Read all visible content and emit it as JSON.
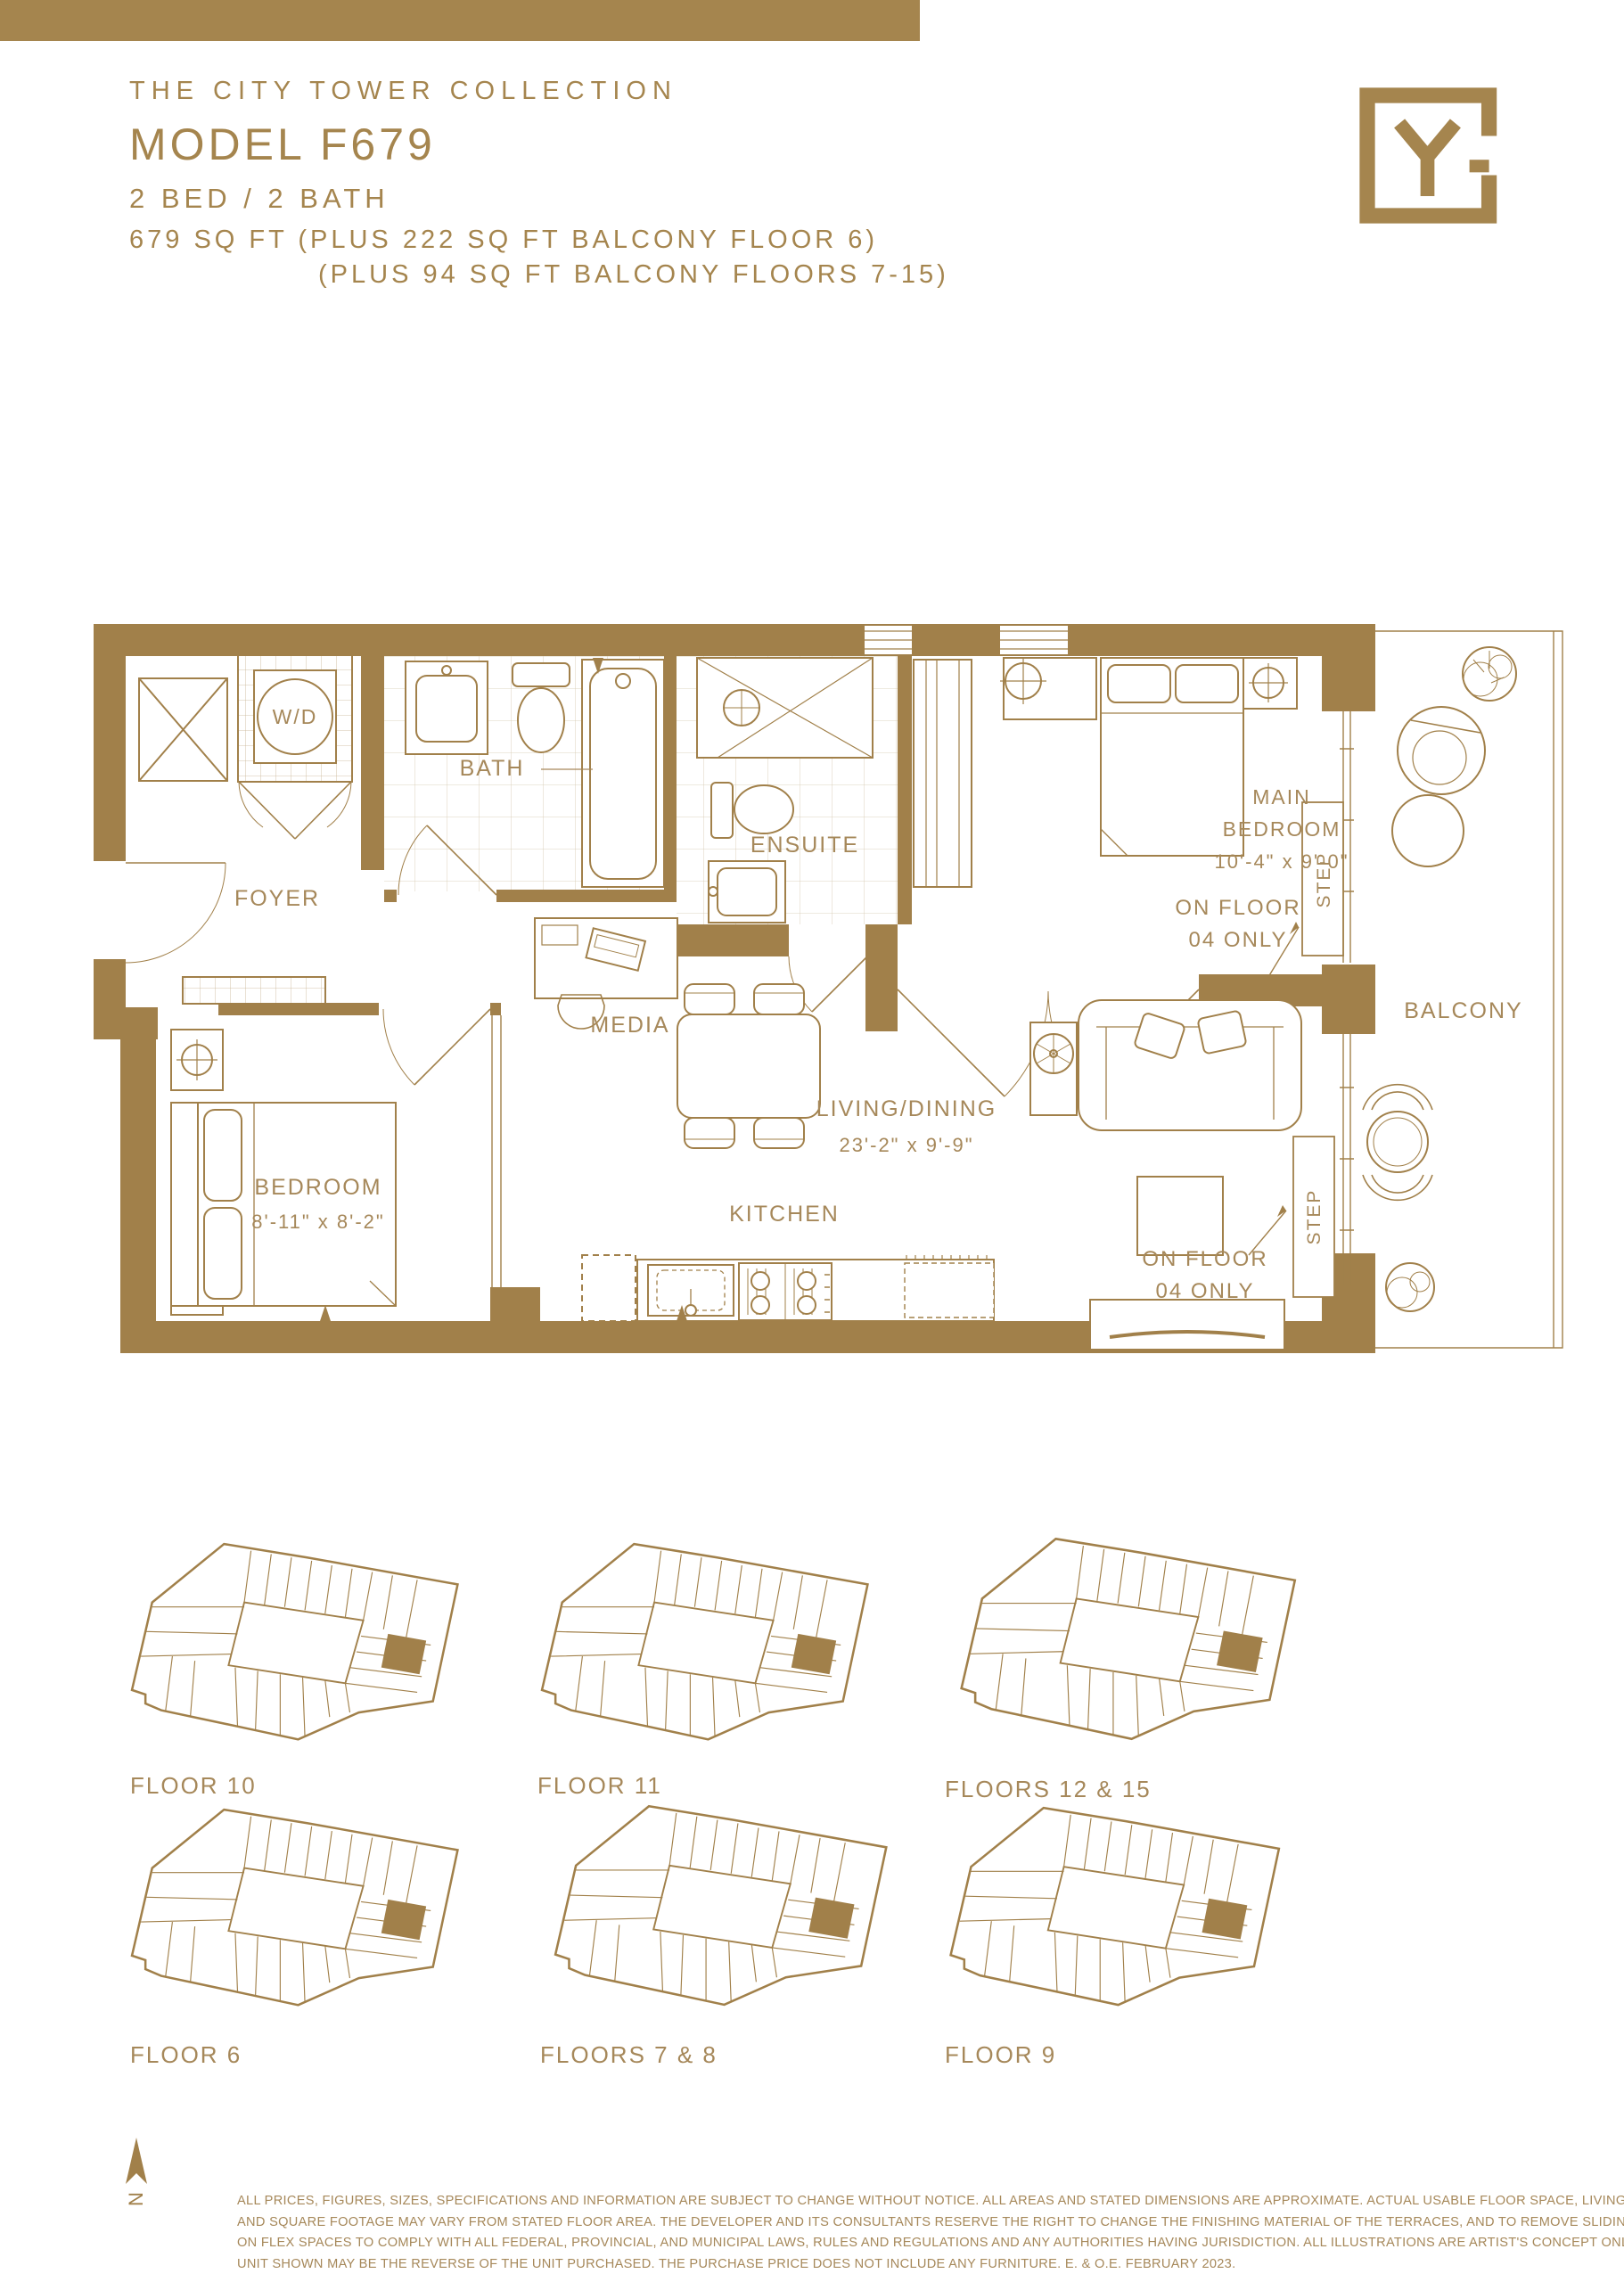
{
  "header": {
    "collection": "THE CITY TOWER COLLECTION",
    "model": "MODEL F679",
    "beds_baths": "2 BED / 2 BATH",
    "area_line1": "679 SQ FT (PLUS 222 SQ FT BALCONY FLOOR 6)",
    "area_line2": "(PLUS 94 SQ FT BALCONY FLOORS 7-15)",
    "logo_letter": "Y"
  },
  "colors": {
    "gold_wall": "#A1804A",
    "gold_bar": "#A5854E",
    "gold_text": "#A6885A",
    "background": "#FFFFFF"
  },
  "floorplan": {
    "labels": {
      "wd": "W/D",
      "bath": "BATH",
      "foyer": "FOYER",
      "ensuite": "ENSUITE",
      "media": "MEDIA",
      "kitchen": "KITCHEN",
      "balcony": "BALCONY",
      "step": "STEP",
      "main_bedroom_line1": "MAIN",
      "main_bedroom_line2": "BEDROOM",
      "main_bedroom_dims": "10'-4\" x 9'-0\"",
      "living_dining": "LIVING/DINING",
      "living_dining_dims": "23'-2\" x 9'-9\"",
      "bedroom": "BEDROOM",
      "bedroom_dims": "8'-11\" x 8'-2\"",
      "on_floor_line1": "ON FLOOR",
      "on_floor_line2": "04 ONLY"
    }
  },
  "keyplans": [
    {
      "label": "FLOOR 10"
    },
    {
      "label": "FLOOR 11"
    },
    {
      "label": "FLOORS 12 & 15"
    },
    {
      "label": "FLOOR 6"
    },
    {
      "label": "FLOORS 7 & 8"
    },
    {
      "label": "FLOOR 9"
    }
  ],
  "footer": {
    "north": "N",
    "disclaimer_lines": [
      "ALL PRICES, FIGURES, SIZES, SPECIFICATIONS AND INFORMATION ARE SUBJECT TO CHANGE WITHOUT NOTICE. ALL AREAS AND STATED DIMENSIONS ARE APPROXIMATE. ACTUAL USABLE FLOOR SPACE, LIVING AREA",
      "AND SQUARE FOOTAGE MAY VARY FROM STATED FLOOR AREA. THE DEVELOPER AND ITS CONSULTANTS RESERVE THE RIGHT TO CHANGE THE FINISHING MATERIAL OF THE TERRACES, AND TO REMOVE SLIDING DOORS",
      "ON FLEX SPACES TO COMPLY WITH ALL FEDERAL, PROVINCIAL, AND MUNICIPAL LAWS, RULES AND REGULATIONS AND ANY AUTHORITIES HAVING JURISDICTION. ALL ILLUSTRATIONS ARE ARTIST'S CONCEPT ONLY. THE",
      "UNIT SHOWN MAY BE THE REVERSE OF THE UNIT PURCHASED. THE PURCHASE PRICE DOES NOT INCLUDE ANY FURNITURE. E. & O.E. FEBRUARY 2023."
    ]
  }
}
